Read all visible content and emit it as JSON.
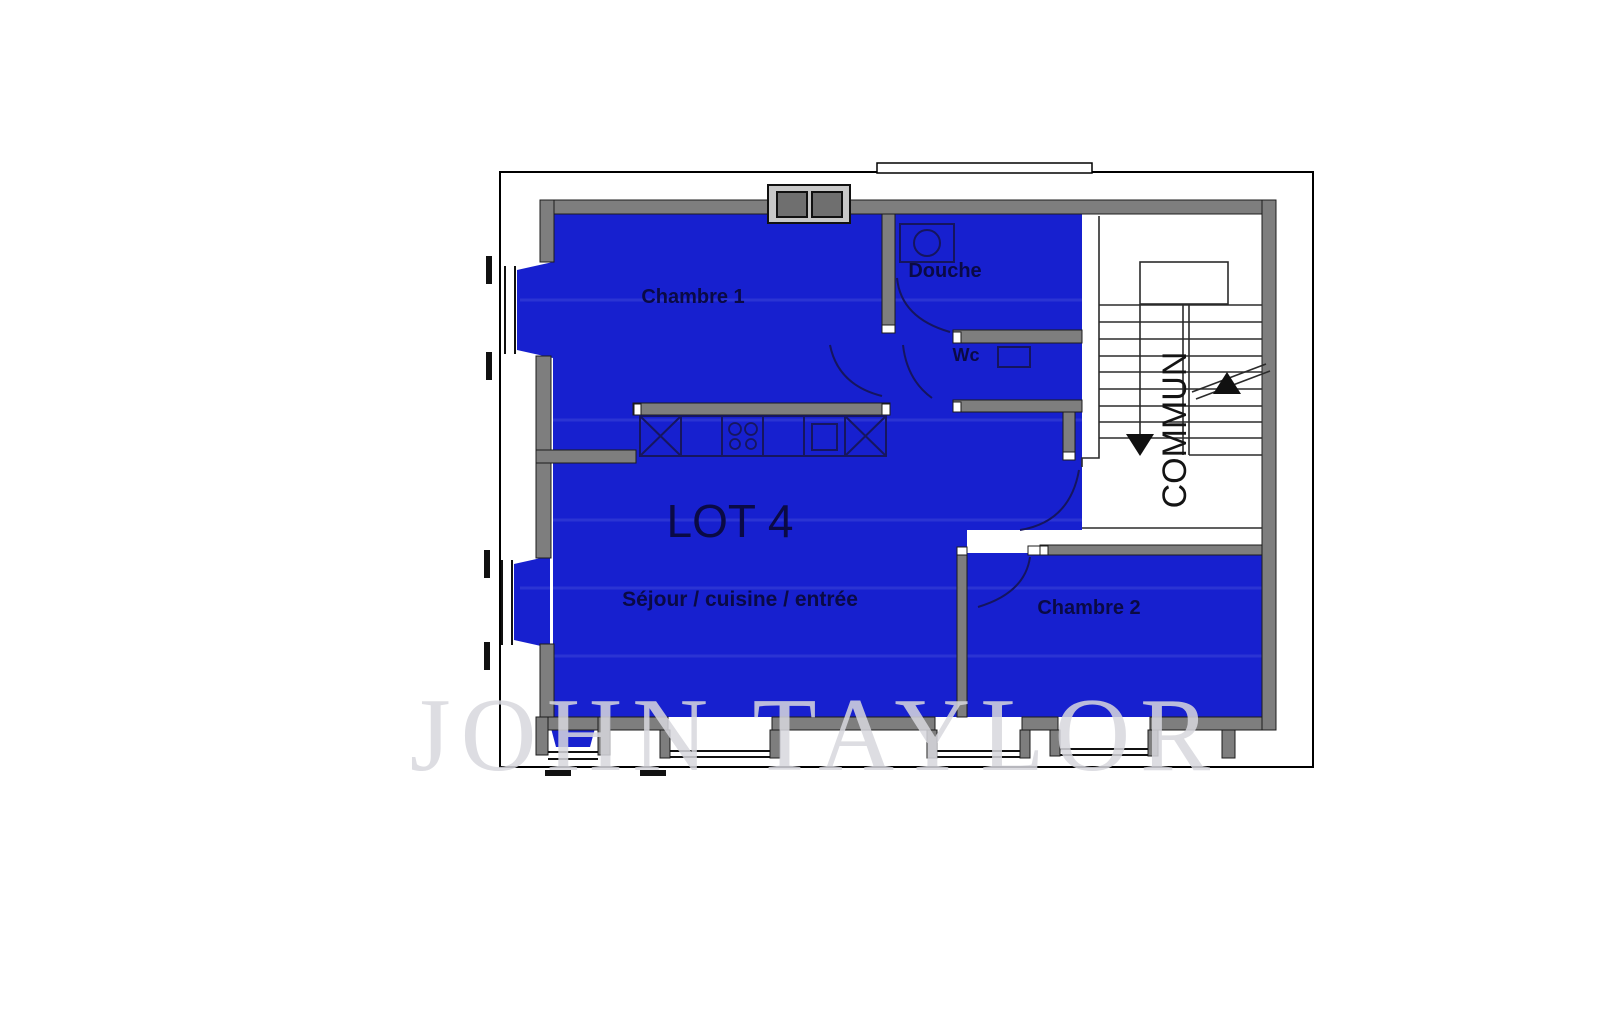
{
  "plan": {
    "lot_label": "LOT 4",
    "labels": {
      "chambre1": "Chambre 1",
      "douche": "Douche",
      "wc": "Wc",
      "sejour": "Séjour / cuisine / entrée",
      "chambre2": "Chambre 2",
      "common": "COMMUN"
    },
    "watermark": "JOHN TAYLOR",
    "colors": {
      "lot_fill": "#1720CF",
      "wall_gray": "#7e7e7e",
      "label_navy": "#0a0a45",
      "watermark_gray": "#d8d8de",
      "background": "#ffffff"
    },
    "icons": [
      "washbasin-icon",
      "toilet-icon",
      "hob-icon",
      "sink-icon",
      "chimney-icon",
      "stairs-up-arrow-icon",
      "stairs-down-arrow-icon",
      "window-symbol",
      "door-arc"
    ]
  }
}
